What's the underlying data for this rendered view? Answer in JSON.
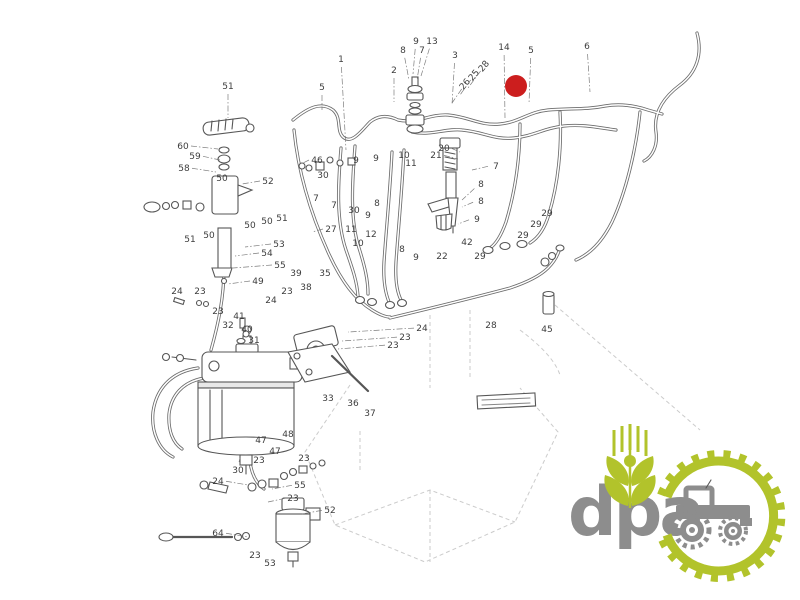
{
  "page": {
    "background": "#ffffff"
  },
  "colors": {
    "ink": "#3d3d3d",
    "line": "#5f5f5f",
    "faint": "#c2c2c2",
    "marker_red": "#cc1e1e",
    "logo_green": "#b2c32b",
    "logo_gray": "#8d8d8d"
  },
  "diagram": {
    "type": "exploded-parts-line-drawing",
    "description": "fuel injection system parts diagram",
    "marker": {
      "x": 516,
      "y": 86,
      "r": 11
    },
    "nameplate": {
      "x": 477,
      "y": 396,
      "width": 58,
      "height": 13,
      "rotation": -3
    },
    "labels": [
      {
        "t": "51",
        "x": 228,
        "y": 89,
        "lx": 228,
        "ly": 118
      },
      {
        "t": "5",
        "x": 322,
        "y": 90,
        "lx": 322,
        "ly": 110
      },
      {
        "t": "1",
        "x": 341,
        "y": 62,
        "lx": 346,
        "ly": 150
      },
      {
        "t": "2",
        "x": 394,
        "y": 73,
        "lx": 394,
        "ly": 102
      },
      {
        "t": "8",
        "x": 403,
        "y": 53,
        "lx": 409,
        "ly": 80
      },
      {
        "t": "9",
        "x": 416,
        "y": 44,
        "lx": 413,
        "ly": 74
      },
      {
        "t": "7",
        "x": 422,
        "y": 53,
        "lx": 417,
        "ly": 80
      },
      {
        "t": "13",
        "x": 432,
        "y": 44,
        "lx": 421,
        "ly": 76
      },
      {
        "t": "3",
        "x": 455,
        "y": 58,
        "lx": 452,
        "ly": 105
      },
      {
        "t": "26",
        "x": 467,
        "y": 86,
        "r": -50,
        "lx": 452,
        "ly": 103
      },
      {
        "t": "25",
        "x": 476,
        "y": 77,
        "r": -50,
        "lx": 460,
        "ly": 95
      },
      {
        "t": "28",
        "x": 486,
        "y": 68,
        "r": -50,
        "lx": 468,
        "ly": 88
      },
      {
        "t": "14",
        "x": 504,
        "y": 50,
        "lx": 505,
        "ly": 118
      },
      {
        "t": "5",
        "x": 531,
        "y": 53,
        "lx": 529,
        "ly": 104
      },
      {
        "t": "6",
        "x": 587,
        "y": 49,
        "lx": 590,
        "ly": 92
      },
      {
        "t": "60",
        "x": 183,
        "y": 149,
        "lx": 218,
        "ly": 149
      },
      {
        "t": "59",
        "x": 195,
        "y": 159,
        "lx": 220,
        "ly": 160
      },
      {
        "t": "58",
        "x": 184,
        "y": 171,
        "lx": 216,
        "ly": 172
      },
      {
        "t": "50",
        "x": 222,
        "y": 181
      },
      {
        "t": "52",
        "x": 268,
        "y": 184,
        "lx": 242,
        "ly": 184
      },
      {
        "t": "51",
        "x": 190,
        "y": 242
      },
      {
        "t": "50",
        "x": 209,
        "y": 238
      },
      {
        "t": "50",
        "x": 250,
        "y": 228
      },
      {
        "t": "50",
        "x": 267,
        "y": 224
      },
      {
        "t": "51",
        "x": 282,
        "y": 221
      },
      {
        "t": "53",
        "x": 279,
        "y": 247,
        "lx": 245,
        "ly": 247
      },
      {
        "t": "54",
        "x": 267,
        "y": 256,
        "lx": 235,
        "ly": 256
      },
      {
        "t": "55",
        "x": 280,
        "y": 268,
        "lx": 233,
        "ly": 268
      },
      {
        "t": "49",
        "x": 258,
        "y": 284,
        "lx": 228,
        "ly": 284
      },
      {
        "t": "46",
        "x": 317,
        "y": 163,
        "lx": 303,
        "ly": 163
      },
      {
        "t": "30",
        "x": 323,
        "y": 178
      },
      {
        "t": "9",
        "x": 356,
        "y": 163
      },
      {
        "t": "9",
        "x": 376,
        "y": 161
      },
      {
        "t": "10",
        "x": 404,
        "y": 158
      },
      {
        "t": "11",
        "x": 411,
        "y": 166
      },
      {
        "t": "7",
        "x": 316,
        "y": 201
      },
      {
        "t": "7",
        "x": 334,
        "y": 208
      },
      {
        "t": "30",
        "x": 354,
        "y": 213
      },
      {
        "t": "9",
        "x": 368,
        "y": 218
      },
      {
        "t": "8",
        "x": 377,
        "y": 206
      },
      {
        "t": "27",
        "x": 331,
        "y": 232,
        "lx": 312,
        "ly": 232
      },
      {
        "t": "11",
        "x": 351,
        "y": 232
      },
      {
        "t": "12",
        "x": 371,
        "y": 237
      },
      {
        "t": "10",
        "x": 358,
        "y": 246
      },
      {
        "t": "8",
        "x": 402,
        "y": 252
      },
      {
        "t": "9",
        "x": 416,
        "y": 260
      },
      {
        "t": "20",
        "x": 444,
        "y": 151,
        "lx": 460,
        "ly": 152
      },
      {
        "t": "21",
        "x": 436,
        "y": 158,
        "lx": 458,
        "ly": 159
      },
      {
        "t": "7",
        "x": 496,
        "y": 169,
        "lx": 472,
        "ly": 170
      },
      {
        "t": "8",
        "x": 481,
        "y": 187,
        "lx": 462,
        "ly": 200
      },
      {
        "t": "8",
        "x": 481,
        "y": 204,
        "lx": 462,
        "ly": 207
      },
      {
        "t": "9",
        "x": 477,
        "y": 222,
        "lx": 458,
        "ly": 224
      },
      {
        "t": "29",
        "x": 547,
        "y": 216
      },
      {
        "t": "29",
        "x": 536,
        "y": 227
      },
      {
        "t": "29",
        "x": 523,
        "y": 238
      },
      {
        "t": "29",
        "x": 480,
        "y": 259
      },
      {
        "t": "42",
        "x": 467,
        "y": 245
      },
      {
        "t": "22",
        "x": 442,
        "y": 259
      },
      {
        "t": "28",
        "x": 491,
        "y": 328
      },
      {
        "t": "45",
        "x": 547,
        "y": 332
      },
      {
        "t": "39",
        "x": 296,
        "y": 276
      },
      {
        "t": "35",
        "x": 325,
        "y": 276
      },
      {
        "t": "24",
        "x": 177,
        "y": 294
      },
      {
        "t": "23",
        "x": 200,
        "y": 294
      },
      {
        "t": "23",
        "x": 287,
        "y": 294
      },
      {
        "t": "38",
        "x": 306,
        "y": 290
      },
      {
        "t": "24",
        "x": 271,
        "y": 303
      },
      {
        "t": "23",
        "x": 218,
        "y": 314
      },
      {
        "t": "41",
        "x": 239,
        "y": 319
      },
      {
        "t": "32",
        "x": 228,
        "y": 328
      },
      {
        "t": "40",
        "x": 247,
        "y": 332
      },
      {
        "t": "31",
        "x": 254,
        "y": 343
      },
      {
        "t": "24",
        "x": 422,
        "y": 331,
        "lx": 348,
        "ly": 332
      },
      {
        "t": "23",
        "x": 405,
        "y": 340,
        "lx": 342,
        "ly": 341
      },
      {
        "t": "23",
        "x": 393,
        "y": 348,
        "lx": 338,
        "ly": 349
      },
      {
        "t": "33",
        "x": 328,
        "y": 401
      },
      {
        "t": "36",
        "x": 353,
        "y": 406
      },
      {
        "t": "37",
        "x": 370,
        "y": 416
      },
      {
        "t": "47",
        "x": 261,
        "y": 443
      },
      {
        "t": "48",
        "x": 288,
        "y": 437
      },
      {
        "t": "47",
        "x": 275,
        "y": 454
      },
      {
        "t": "23",
        "x": 259,
        "y": 463
      },
      {
        "t": "23",
        "x": 304,
        "y": 461
      },
      {
        "t": "30",
        "x": 238,
        "y": 473,
        "lx": 240,
        "ly": 458
      },
      {
        "t": "24",
        "x": 218,
        "y": 484,
        "lx": 248,
        "ly": 485
      },
      {
        "t": "55",
        "x": 300,
        "y": 488,
        "lx": 272,
        "ly": 489
      },
      {
        "t": "23",
        "x": 293,
        "y": 501,
        "lx": 268,
        "ly": 502
      },
      {
        "t": "52",
        "x": 330,
        "y": 513,
        "lx": 302,
        "ly": 514
      },
      {
        "t": "64",
        "x": 218,
        "y": 536,
        "lx": 248,
        "ly": 537
      },
      {
        "t": "23",
        "x": 255,
        "y": 558
      },
      {
        "t": "53",
        "x": 270,
        "y": 566
      }
    ]
  },
  "logo": {
    "text": "dpa",
    "elements": [
      "wheat-emblem",
      "gear-ring",
      "tractor-icon"
    ]
  }
}
